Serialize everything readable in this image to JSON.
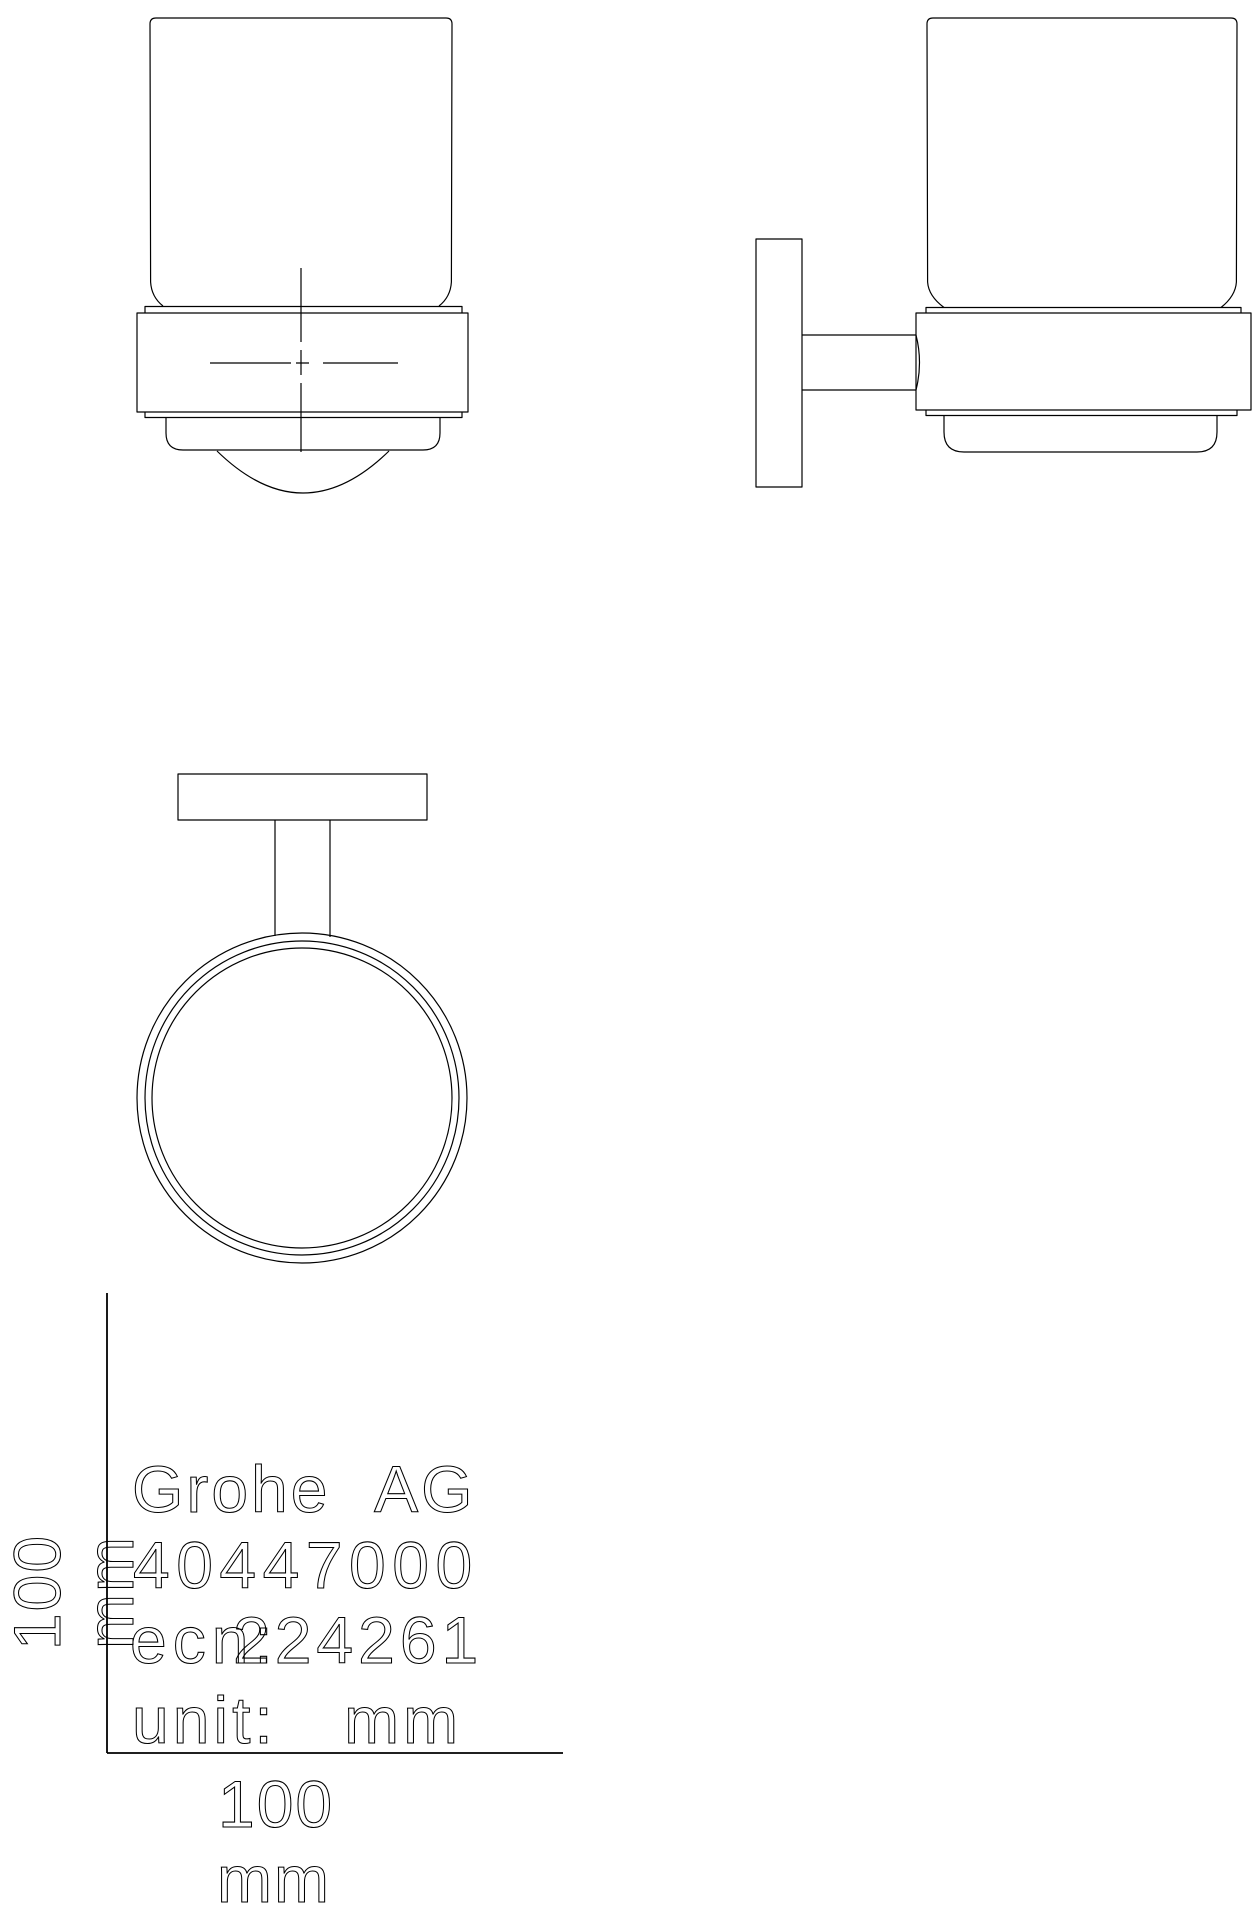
{
  "drawing": {
    "background_color": "#ffffff",
    "line_color": "#000000",
    "title_block": {
      "company": "Grohe AG",
      "product_number": "40447000",
      "ecn_label": "ecn:",
      "ecn_number": "224261",
      "unit_line": "unit: mm"
    },
    "scale": {
      "x_value": "100",
      "x_unit": "mm",
      "y_value": "100",
      "y_unit": "mm"
    }
  }
}
